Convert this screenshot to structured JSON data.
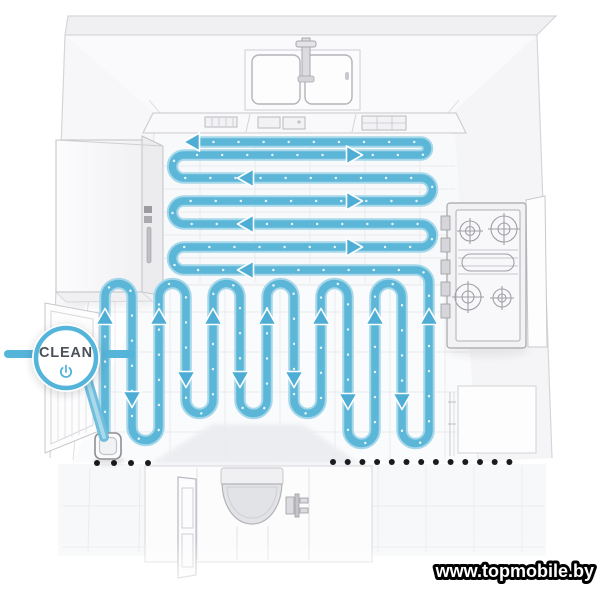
{
  "title": "Robot vacuum serpentine cleaning path diagram",
  "callout": {
    "label": "CLEAN",
    "icon": "power-icon",
    "ring_color": "#55b4da",
    "label_color": "#4b5158"
  },
  "watermark": {
    "text": "www.topmobile.by"
  },
  "path": {
    "pattern_upper": "horizontal-serpentine",
    "upper_passes": 7,
    "pattern_lower": "vertical-serpentine",
    "lower_columns": 13,
    "color": "#5cb6d8",
    "edge_color": "#a5d7ea",
    "dot_color": "#e8f6fb",
    "arrow_color": "#4dadd4"
  },
  "boundary": {
    "type": "dotted-virtual-wall",
    "dot_color": "#1b1b1d",
    "left_count": 4,
    "right_count": 13
  },
  "objects": [
    "double-basin-sink",
    "faucet",
    "countertop",
    "refrigerator",
    "gas-stove",
    "left-wall-door",
    "robot-vacuum",
    "doorway",
    "toilet",
    "bathroom-door",
    "right-wall-cabinet"
  ]
}
